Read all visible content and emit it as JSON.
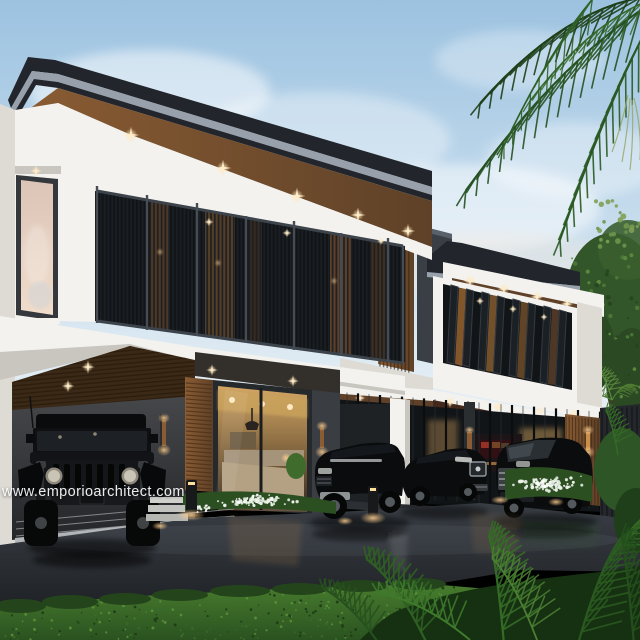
{
  "watermark": {
    "text": "www.emporioarchitect.com"
  },
  "palette": {
    "sky_top": "#9cc2e0",
    "sky_mid": "#c9deee",
    "sky_low": "#eaf1f5",
    "cloud": "#ffffff",
    "roof_dark": "#22262c",
    "roof_gray": "#98a1ab",
    "soffit_wood": "#5e4128",
    "soffit_wood_lit": "#8a5c33",
    "wall_white": "#f3f2ee",
    "wall_shade": "#dedbd5",
    "slab_shade": "#c9c6c0",
    "louver_dark": "#15181c",
    "louver_frame": "#3c434b",
    "wood_accent": "#7c5130",
    "wood_dark": "#44291a",
    "dark_wall": "#3a3d41",
    "dark_wall2": "#2c2f33",
    "glass_night": "#121517",
    "warm_glow": "#ffd9a0",
    "warm_deep": "#c98f4a",
    "window_dusk_top": "#dcc4b6",
    "window_dusk_bottom": "#f0dccb",
    "carport_ceiling": "#3b2917",
    "tile": "#b4b7b9",
    "drive_top": "#3a3f46",
    "drive_bottom": "#17191c",
    "lawn_light": "#4a7f2f",
    "lawn_dark": "#2a5220",
    "leaf_dark": "#1e3f19",
    "leaf_mid": "#2f5f24",
    "leaf_light": "#4c7f33",
    "car_black": "#0b0c0e",
    "car_trim": "#aeb4b8",
    "white_flower": "#eef2ea",
    "fence": "#24272c"
  }
}
